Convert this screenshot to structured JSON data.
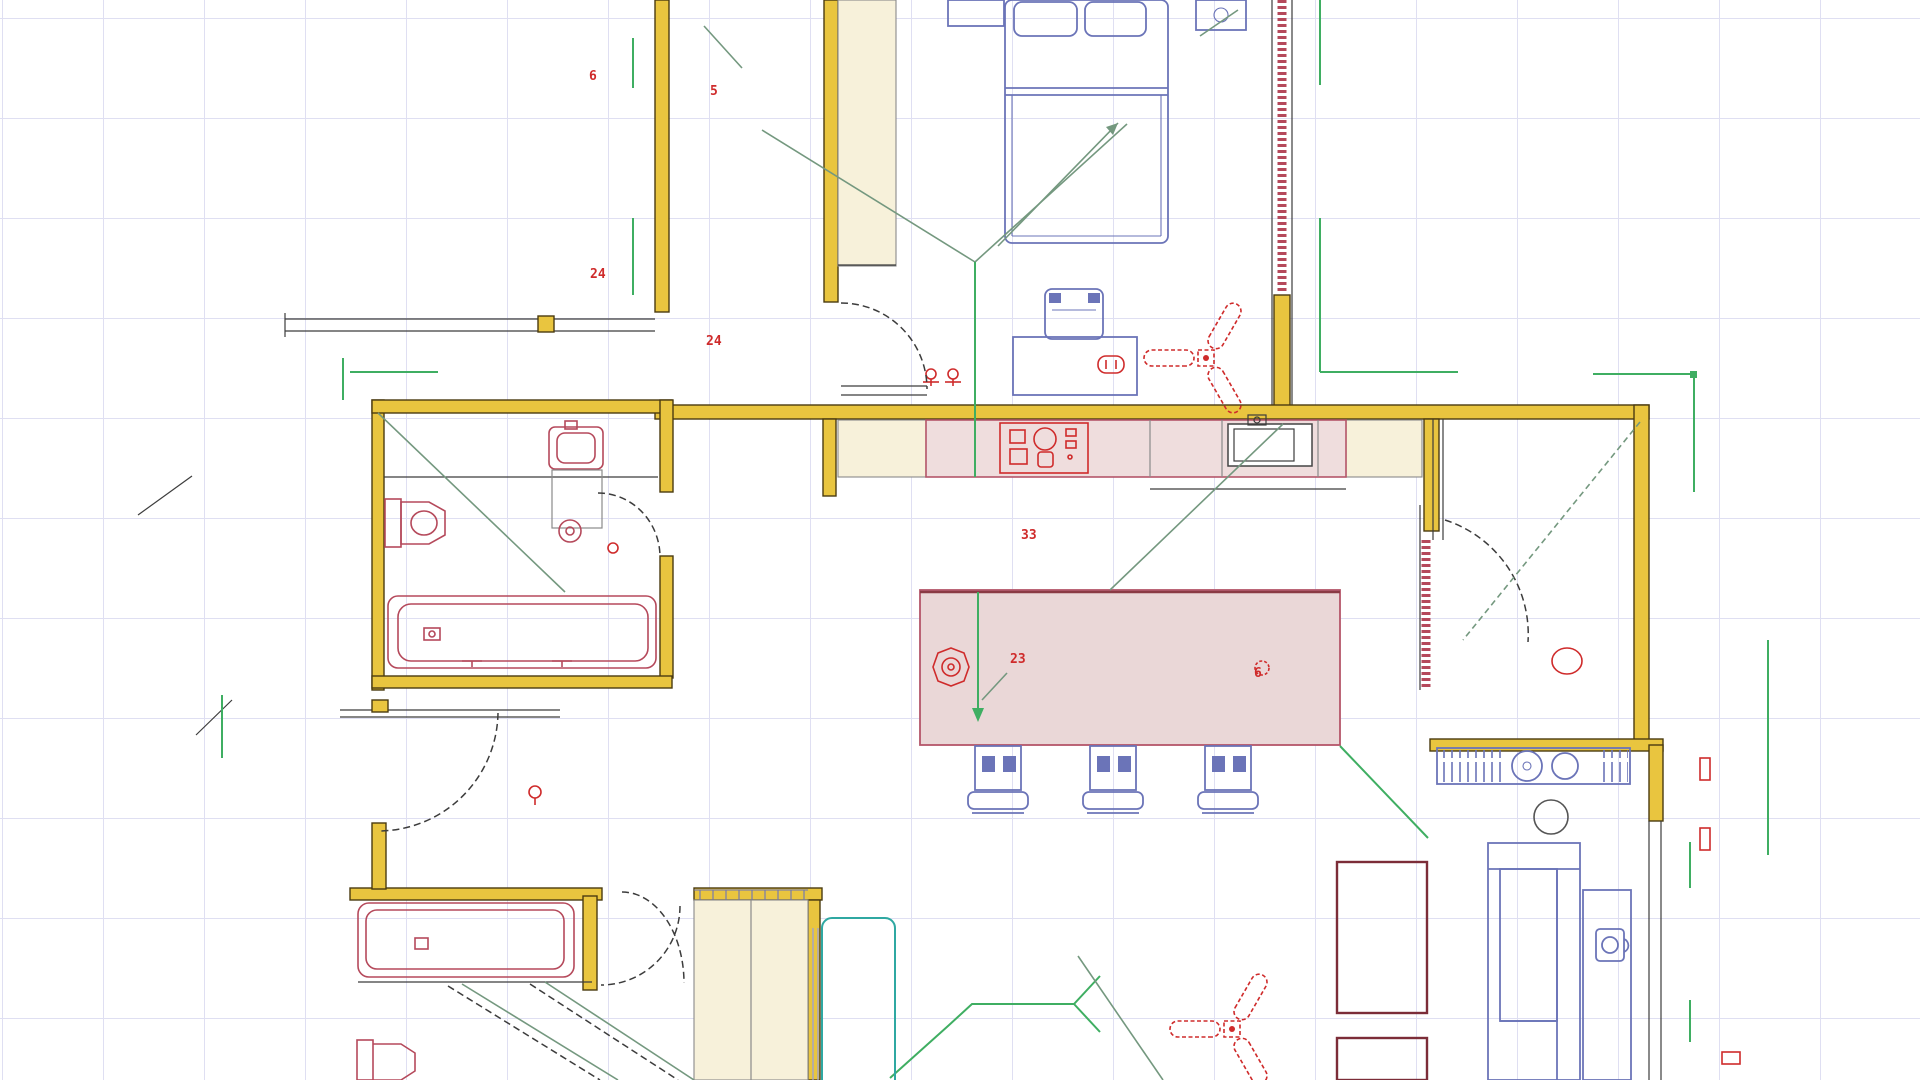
{
  "title": "Residential floor plan - CAD drawing canvas",
  "colors": {
    "bg": "#ffffff",
    "grid": "#dfdff2",
    "wall-fill": "#e9c53f",
    "wall-edge": "#4a3b10",
    "closet-fill": "#f7f1da",
    "closet-edge": "#8a8a8a",
    "counter-pink": "#efdddd",
    "island-pink": "#ead7d7",
    "counter-edge": "#b4566a",
    "furniture-blue": "#6b74b8",
    "fixture-red": "#b5495b",
    "signal-red": "#cf2b2b",
    "wire-green": "#3fae62",
    "wire-muted": "#74987f",
    "rug-maroon": "#7c2d38",
    "teal": "#2fa8a2",
    "line-dark": "#3c3c3c",
    "lavender": "#9aa0d8"
  },
  "annotations": [
    {
      "id": "dim-corridor-top",
      "text": "6"
    },
    {
      "id": "dim-corridor-mid",
      "text": "24"
    },
    {
      "id": "dim-hall-top",
      "text": "5"
    },
    {
      "id": "dim-hall-mid",
      "text": "24"
    },
    {
      "id": "dim-kitchen",
      "text": "33"
    },
    {
      "id": "dim-island",
      "text": "23"
    },
    {
      "id": "dim-island-right",
      "text": "6"
    }
  ]
}
